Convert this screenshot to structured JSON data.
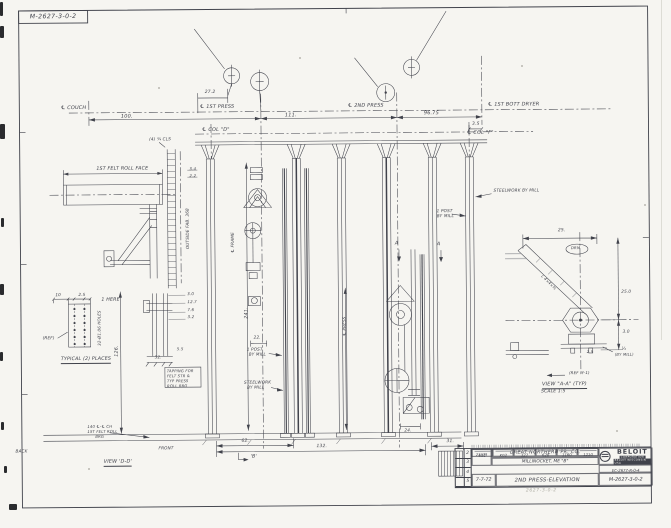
{
  "sheet": {
    "corner_number": "M-2627-3-0-2",
    "ink_color": "#40424b",
    "paper_color": "#f6f5f1"
  },
  "annotations": [
    {
      "id": "cl-couch",
      "text": "℄ COUCH",
      "x": 62,
      "y": 104,
      "fs": 5
    },
    {
      "id": "dim-100",
      "text": "100.",
      "x": 122,
      "y": 113,
      "fs": 5
    },
    {
      "id": "cl-1st-press",
      "text": "℄ 1ST PRESS",
      "x": 201,
      "y": 104,
      "fs": 5
    },
    {
      "id": "dim-27-2",
      "text": "27.2",
      "x": 206,
      "y": 90,
      "fs": 4.5
    },
    {
      "id": "cl-2nd-press",
      "text": "℄ 2ND PRESS",
      "x": 349,
      "y": 104,
      "fs": 5
    },
    {
      "id": "dim-111",
      "text": "111.",
      "x": 286,
      "y": 113,
      "fs": 5
    },
    {
      "id": "dim-96-75",
      "text": "96.75",
      "x": 425,
      "y": 112,
      "fs": 5
    },
    {
      "id": "cl-dryer",
      "text": "℄ 1ST BOTT DRYER",
      "x": 489,
      "y": 104,
      "fs": 5
    },
    {
      "id": "dim-3-5",
      "text": "3.5",
      "x": 473,
      "y": 124,
      "fs": 4.5
    },
    {
      "id": "cl-col-d",
      "text": "℄ COL \"D\"",
      "x": 203,
      "y": 127,
      "fs": 5
    },
    {
      "id": "cl-col-f",
      "text": "℄ COL \"F\"",
      "x": 468,
      "y": 132,
      "fs": 5
    },
    {
      "id": "felt-roll-face",
      "text": "1ST FELT ROLL FACE",
      "x": 97,
      "y": 165,
      "fs": 4.8
    },
    {
      "id": "dim-3-4",
      "text": "3.4",
      "x": 190,
      "y": 166,
      "fs": 4
    },
    {
      "id": "dim-2-2",
      "text": "2.2",
      "x": 190,
      "y": 173,
      "fs": 4
    },
    {
      "id": "note-cls",
      "text": "(4) ¾ CLS",
      "x": 150,
      "y": 136,
      "fs": 4.2
    },
    {
      "id": "outside-fab",
      "text": "OUTSIDE FAB. 368",
      "x": 186,
      "y": 248,
      "fs": 4.2,
      "rot": -90
    },
    {
      "id": "dim-10",
      "text": "10",
      "x": 55,
      "y": 291,
      "fs": 4.2
    },
    {
      "id": "dim-2-5",
      "text": "2.5",
      "x": 78,
      "y": 291,
      "fs": 4.2
    },
    {
      "id": "ref",
      "text": "(REF)",
      "x": 42,
      "y": 334,
      "fs": 4.2
    },
    {
      "id": "holes",
      "text": "32-Ø1.06 HOLES",
      "x": 97,
      "y": 344,
      "fs": 4,
      "rot": -90
    },
    {
      "id": "here",
      "text": "1 HERE",
      "x": 101,
      "y": 296,
      "fs": 4.8
    },
    {
      "id": "typical",
      "text": "TYPICAL (2) PLACES",
      "x": 60,
      "y": 355,
      "fs": 4.8,
      "u": true
    },
    {
      "id": "dim-126",
      "text": "126.",
      "x": 114,
      "y": 355,
      "fs": 4.8,
      "rot": -90
    },
    {
      "id": "dim-3-0",
      "text": "3.0",
      "x": 187,
      "y": 291,
      "fs": 4
    },
    {
      "id": "dim-12-7",
      "text": "12.7",
      "x": 187,
      "y": 299,
      "fs": 4
    },
    {
      "id": "dim-7-6",
      "text": "7.6",
      "x": 187,
      "y": 307,
      "fs": 4
    },
    {
      "id": "dim-3-2",
      "text": "3.2",
      "x": 187,
      "y": 314,
      "fs": 4
    },
    {
      "id": "dim-5-5",
      "text": "5.5",
      "x": 176,
      "y": 346,
      "fs": 4
    },
    {
      "id": "dim-32",
      "text": "32.",
      "x": 154,
      "y": 354,
      "fs": 4
    },
    {
      "id": "note-tap-1",
      "text": "TAPPING FOR",
      "x": 166,
      "y": 368,
      "fs": 3.8
    },
    {
      "id": "note-tap-2",
      "text": "FELT STR &",
      "x": 166,
      "y": 373,
      "fs": 3.8
    },
    {
      "id": "note-tap-3",
      "text": "TYP PRESS",
      "x": 166,
      "y": 378,
      "fs": 3.8
    },
    {
      "id": "note-tap-4",
      "text": "ROLL BRG",
      "x": 166,
      "y": 383,
      "fs": 3.8
    },
    {
      "id": "cl-frame",
      "text": "℄ FRAME",
      "x": 231,
      "y": 252,
      "fs": 4.2,
      "rot": -90
    },
    {
      "id": "dim-241",
      "text": "241.",
      "x": 244,
      "y": 318,
      "fs": 4.8,
      "rot": -90
    },
    {
      "id": "dim-22",
      "text": "22.",
      "x": 253,
      "y": 335,
      "fs": 4.2
    },
    {
      "id": "post-mill-l1",
      "text": "1 POST",
      "x": 246,
      "y": 347,
      "fs": 4.2
    },
    {
      "id": "post-mill-l2",
      "text": "BY MILL",
      "x": 248,
      "y": 352,
      "fs": 4.2
    },
    {
      "id": "steel-mill-l1",
      "text": "STEELWORK",
      "x": 243,
      "y": 380,
      "fs": 4.2
    },
    {
      "id": "steel-mill-l2",
      "text": "BY MILL",
      "x": 246,
      "y": 385,
      "fs": 4.2
    },
    {
      "id": "cl-press",
      "text": "℄ PRESS",
      "x": 342,
      "y": 336,
      "fs": 4.2,
      "rot": -90
    },
    {
      "id": "cut-a-1",
      "text": "A",
      "x": 395,
      "y": 242,
      "fs": 5
    },
    {
      "id": "cut-a-2",
      "text": "A",
      "x": 437,
      "y": 243,
      "fs": 5
    },
    {
      "id": "post-mill-r1",
      "text": "1 POST",
      "x": 437,
      "y": 210,
      "fs": 4.2
    },
    {
      "id": "post-mill-r2",
      "text": "BY MILL",
      "x": 437,
      "y": 215,
      "fs": 4.2
    },
    {
      "id": "steel-by-mill-r",
      "text": "STEELWORK BY MILL",
      "x": 494,
      "y": 190,
      "fs": 4.2
    },
    {
      "id": "dim-24",
      "text": "24.",
      "x": 403,
      "y": 429,
      "fs": 4.2
    },
    {
      "id": "cc-1",
      "text": "140 ℄-℄ CH",
      "x": 86,
      "y": 423,
      "fs": 3.8
    },
    {
      "id": "cc-2",
      "text": "1ST FELT ROLL",
      "x": 86,
      "y": 428,
      "fs": 3.8
    },
    {
      "id": "cc-3",
      "text": "BRG",
      "x": 94,
      "y": 433,
      "fs": 3.8
    },
    {
      "id": "front",
      "text": "FRONT",
      "x": 157,
      "y": 445,
      "fs": 4.2
    },
    {
      "id": "back",
      "text": "BACK",
      "x": 14,
      "y": 447,
      "fs": 4.2
    },
    {
      "id": "dim-62",
      "text": "62.",
      "x": 240,
      "y": 439,
      "fs": 4.5
    },
    {
      "id": "dim-132",
      "text": "132.",
      "x": 315,
      "y": 445,
      "fs": 4.5
    },
    {
      "id": "dim-31",
      "text": "31.",
      "x": 445,
      "y": 441,
      "fs": 4.5
    },
    {
      "id": "marker-b",
      "text": "'B'",
      "x": 249,
      "y": 454,
      "fs": 4.8
    },
    {
      "id": "view-dd",
      "text": "VIEW 'D-D'",
      "x": 102,
      "y": 458,
      "fs": 5,
      "u": true
    },
    {
      "id": "dim-25",
      "text": "25.",
      "x": 558,
      "y": 231,
      "fs": 4.5
    },
    {
      "id": "drm",
      "text": "DRM",
      "x": 571,
      "y": 248,
      "fs": 3.8
    },
    {
      "id": "brace-callout",
      "text": "L 4×4×⅜",
      "x": 543,
      "y": 276,
      "fs": 3.8,
      "rot": 45
    },
    {
      "id": "dim-25-0",
      "text": "25.0",
      "x": 621,
      "y": 292,
      "fs": 4.2
    },
    {
      "id": "dim-3-0b",
      "text": "3.0",
      "x": 622,
      "y": 332,
      "fs": 4.2
    },
    {
      "id": "dim-quarter",
      "text": "¼",
      "x": 621,
      "y": 349,
      "fs": 4.2
    },
    {
      "id": "by-mill-aa",
      "text": "(BY MILL)",
      "x": 614,
      "y": 355,
      "fs": 3.8
    },
    {
      "id": "dim-2-5b",
      "text": "2.5",
      "x": 586,
      "y": 352,
      "fs": 3.8
    },
    {
      "id": "ref-m1",
      "text": "(REF M-1)",
      "x": 568,
      "y": 373,
      "fs": 4
    },
    {
      "id": "view-aa",
      "text": "VIEW \"A-A\" (TYP)",
      "x": 541,
      "y": 384,
      "fs": 5,
      "u": true
    },
    {
      "id": "scale",
      "text": "SCALE 1:5",
      "x": 540,
      "y": 392,
      "fs": 4.5
    }
  ],
  "title_block": {
    "customer_line1": "GREAT NORTHERN PR. CO.",
    "customer_line2": "MILLINOCKET, ME \"B\"",
    "order_no": "23379",
    "cells": [
      "631",
      "K02",
      "327",
      "628",
      "1160",
      "1210"
    ],
    "date": "7-7-72",
    "drawing_title": "2ND PRESS-ELEVATION",
    "drawing_number": "M-2627-3-0-2",
    "secondary_number": "EC-2677-R-0-4",
    "logo_name": "BELOIT",
    "logo_sub1": "CORPORATION",
    "logo_sub2": "BELOIT WISCONSIN USA",
    "rev_rows": [
      "2",
      "3",
      "4",
      "5"
    ],
    "pencil_note": "2627-3-0-2"
  }
}
